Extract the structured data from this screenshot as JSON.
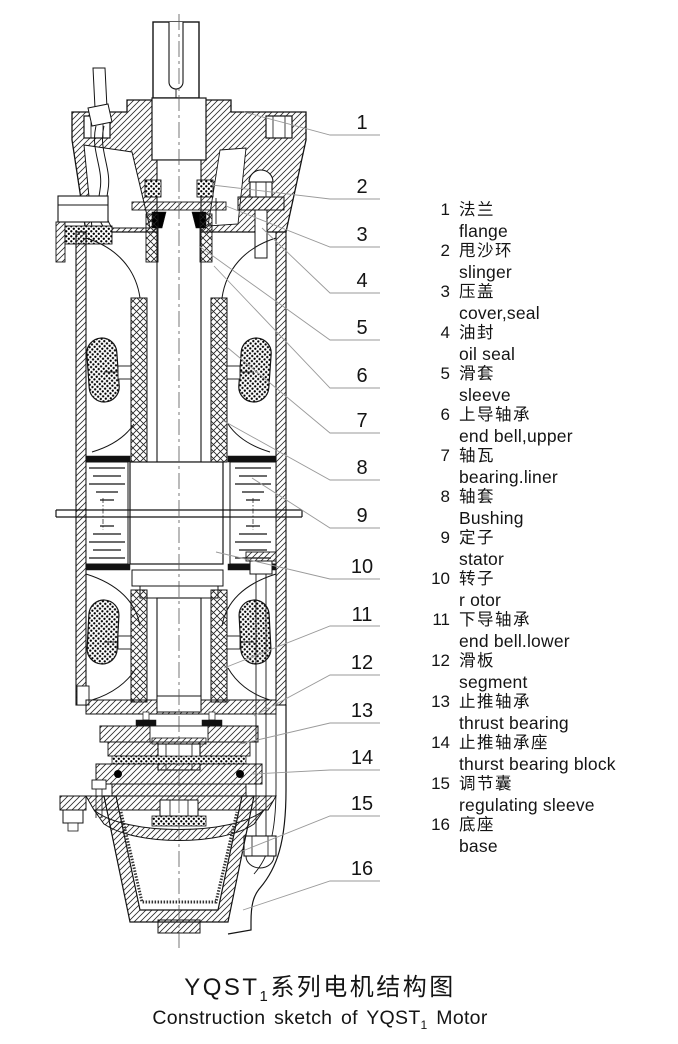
{
  "diagram": {
    "title": "motor cross-section sketch",
    "callouts": [
      "1",
      "2",
      "3",
      "4",
      "5",
      "6",
      "7",
      "8",
      "9",
      "10",
      "11",
      "12",
      "13",
      "14",
      "15",
      "16"
    ]
  },
  "legend": {
    "items": [
      {
        "num": "1",
        "zh": "法兰",
        "en": "flange"
      },
      {
        "num": "2",
        "zh": "甩沙环",
        "en": "slinger"
      },
      {
        "num": "3",
        "zh": "压盖",
        "en": "cover,seal"
      },
      {
        "num": "4",
        "zh": "油封",
        "en": "oil seal"
      },
      {
        "num": "5",
        "zh": "滑套",
        "en": "sleeve"
      },
      {
        "num": "6",
        "zh": "上导轴承",
        "en": "end bell,upper"
      },
      {
        "num": "7",
        "zh": "轴瓦",
        "en": "bearing.liner"
      },
      {
        "num": "8",
        "zh": "轴套",
        "en": "Bushing"
      },
      {
        "num": "9",
        "zh": "定子",
        "en": "stator"
      },
      {
        "num": "10",
        "zh": "转子",
        "en": "r otor"
      },
      {
        "num": "11",
        "zh": "下导轴承",
        "en": "end bell.lower"
      },
      {
        "num": "12",
        "zh": "滑板",
        "en": "segment"
      },
      {
        "num": "13",
        "zh": "止推轴承",
        "en": "thrust bearing"
      },
      {
        "num": "14",
        "zh": "止推轴承座",
        "en": "thurst bearing block"
      },
      {
        "num": "15",
        "zh": "调节囊",
        "en": "regulating sleeve"
      },
      {
        "num": "16",
        "zh": "底座",
        "en": "base"
      }
    ]
  },
  "caption": {
    "zh_prefix": "YQST",
    "zh_sub": "1",
    "zh_suffix": "系列电机结构图",
    "en_prefix": "Construction sketch of YQST",
    "en_sub": "1",
    "en_suffix": " Motor"
  },
  "colors": {
    "line": "#141414",
    "leader": "#9a9a9a",
    "fill_dark": "#111111"
  }
}
